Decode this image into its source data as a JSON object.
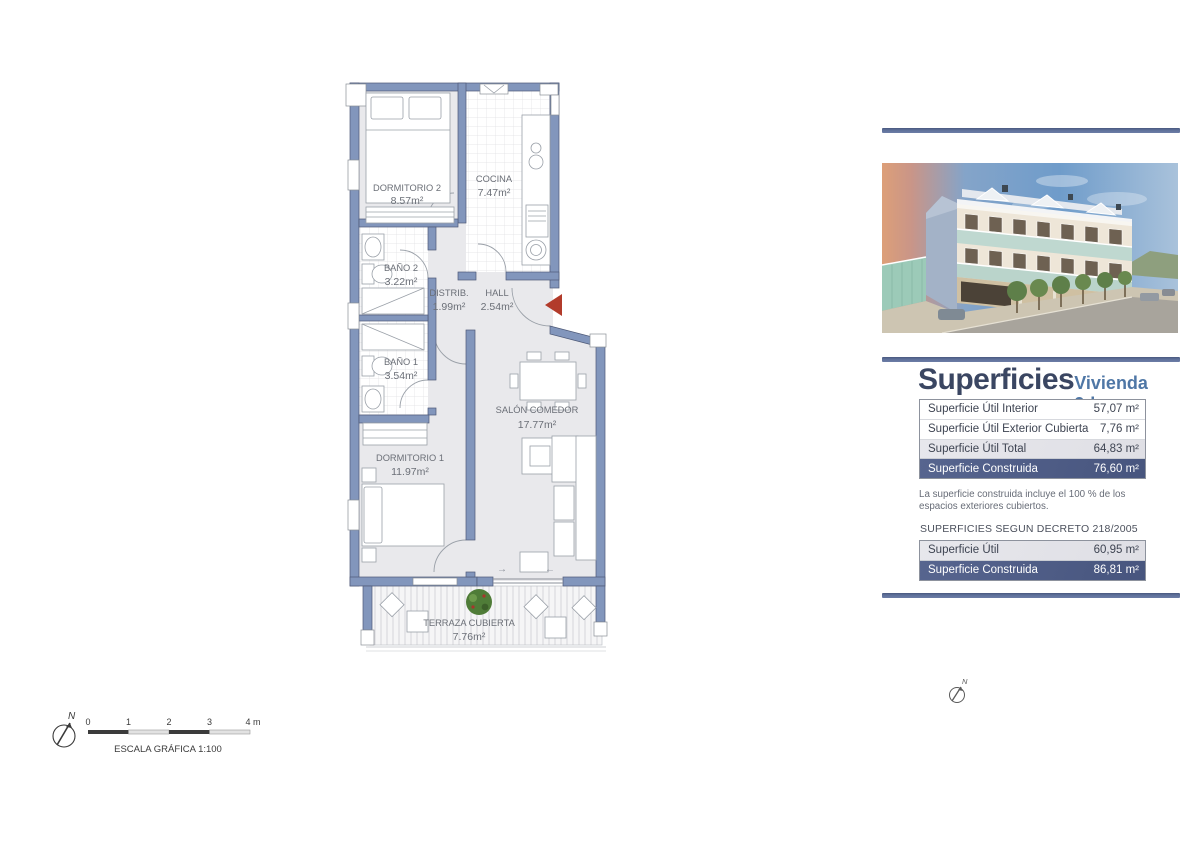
{
  "plan": {
    "rooms": [
      {
        "name": "DORMITORIO 2",
        "area": "8.57m²"
      },
      {
        "name": "COCINA",
        "area": "7.47m²"
      },
      {
        "name": "BAÑO 2",
        "area": "3.22m²"
      },
      {
        "name": "DISTRIB.",
        "area": "1.99m²"
      },
      {
        "name": "HALL",
        "area": "2.54m²"
      },
      {
        "name": "BAÑO 1",
        "area": "3.54m²"
      },
      {
        "name": "DORMITORIO 1",
        "area": "11.97m²"
      },
      {
        "name": "SALÓN COMEDOR",
        "area": "17.77m²"
      },
      {
        "name": "TERRAZA CUBIERTA",
        "area": "7.76m²"
      }
    ],
    "door_arrow_right": "→",
    "door_arrow_left": "←"
  },
  "scale_bar": {
    "ticks": [
      "0",
      "1",
      "2",
      "3",
      "4 m"
    ],
    "label": "ESCALA GRÁFICA   1:100",
    "north": "N"
  },
  "panel": {
    "title": "Superficies",
    "subtitle": "Vivienda 2d",
    "table1": {
      "rows": [
        {
          "label": "Superficie Útil Interior",
          "value": "57,07 m²"
        },
        {
          "label": "Superficie Útil Exterior Cubierta",
          "value": "7,76 m²"
        },
        {
          "label": "Superficie Útil Total",
          "value": "64,83 m²"
        },
        {
          "label": "Superficie Construida",
          "value": "76,60 m²"
        }
      ]
    },
    "note": "La superficie construida incluye el 100 % de los espacios exteriores cubiertos.",
    "decree_heading": "SUPERFICIES SEGUN DECRETO 218/2005",
    "table2": {
      "rows": [
        {
          "label": "Superficie Útil",
          "value": "60,95 m²"
        },
        {
          "label": "Superficie Construida",
          "value": "86,81 m²"
        }
      ]
    },
    "north": "N"
  },
  "colors": {
    "accent_bar": "#5d6f99",
    "dark_row": "#4d5c8a",
    "wall": "#8296bc",
    "entrance_arrow": "#b23b2b"
  }
}
